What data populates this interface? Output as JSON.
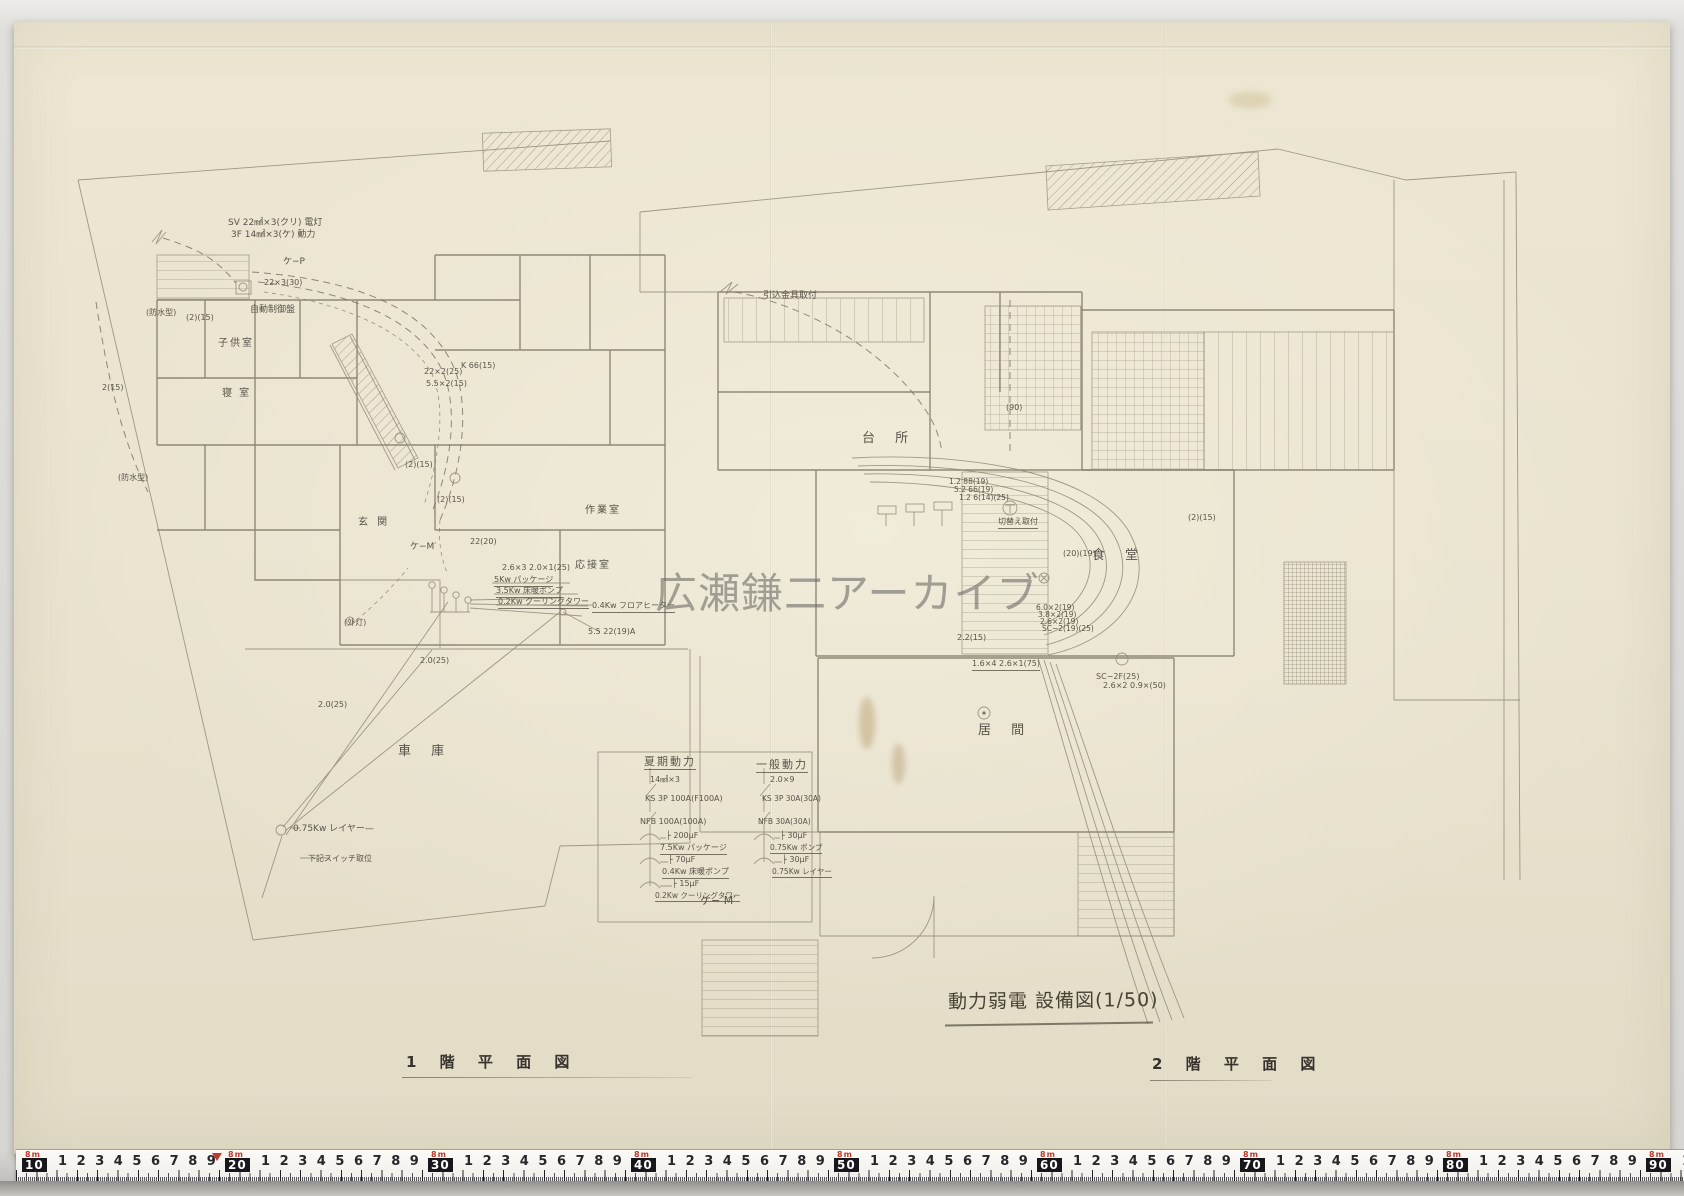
{
  "watermark": "広瀬鎌二アーカイブ",
  "sheet_title": "動力弱電 設備図(1/50)",
  "plan_titles": {
    "left": "1 階 平 面 図",
    "right": "2 階 平 面 図"
  },
  "labels": [
    {
      "t": "SV 22㎟×3(クリ) 電灯",
      "x": 228,
      "y": 219,
      "s": 9
    },
    {
      "t": "3F 14㎟×3(ケ) 動力",
      "x": 231,
      "y": 231,
      "s": 9
    },
    {
      "t": "ケ−P",
      "x": 283,
      "y": 258,
      "s": 9
    },
    {
      "t": "22×3(30)",
      "x": 264,
      "y": 279,
      "s": 8
    },
    {
      "t": "自動制御盤",
      "x": 250,
      "y": 306,
      "s": 9
    },
    {
      "t": "(防水型)",
      "x": 146,
      "y": 309,
      "s": 8
    },
    {
      "t": "(2)(15)",
      "x": 186,
      "y": 314,
      "s": 8
    },
    {
      "t": "2(15)",
      "x": 102,
      "y": 384,
      "s": 8
    },
    {
      "t": "(防水型)",
      "x": 118,
      "y": 474,
      "s": 8
    },
    {
      "t": "子供室",
      "x": 218,
      "y": 338,
      "s": 10,
      "ls": 2
    },
    {
      "t": "寝 室",
      "x": 222,
      "y": 388,
      "s": 10,
      "ls": 2
    },
    {
      "t": "玄 関",
      "x": 358,
      "y": 517,
      "s": 10,
      "ls": 3
    },
    {
      "t": "作業室",
      "x": 585,
      "y": 505,
      "s": 10,
      "ls": 2
    },
    {
      "t": "応接室",
      "x": 575,
      "y": 560,
      "s": 10,
      "ls": 2
    },
    {
      "t": "車 庫",
      "x": 398,
      "y": 745,
      "s": 13,
      "ls": 8
    },
    {
      "t": "22×2(25)",
      "x": 424,
      "y": 368,
      "s": 8
    },
    {
      "t": "K 66(15)",
      "x": 461,
      "y": 362,
      "s": 8
    },
    {
      "t": "5.5×2(15)",
      "x": 426,
      "y": 380,
      "s": 8
    },
    {
      "t": "(2)(15)",
      "x": 405,
      "y": 461,
      "s": 8
    },
    {
      "t": "(2)(15)",
      "x": 437,
      "y": 496,
      "s": 8
    },
    {
      "t": "22(20)",
      "x": 470,
      "y": 538,
      "s": 8
    },
    {
      "t": "ケ−M′",
      "x": 410,
      "y": 543,
      "s": 9
    },
    {
      "t": "2.6×3 2.0×1(25)",
      "x": 502,
      "y": 564,
      "s": 8
    },
    {
      "t": "5Kw パッケージ",
      "x": 494,
      "y": 576,
      "s": 8,
      "u": 1
    },
    {
      "t": "3.5Kw 床暖ポンプ",
      "x": 496,
      "y": 587,
      "s": 8,
      "u": 1
    },
    {
      "t": "0.2Kw クーリングタワー",
      "x": 498,
      "y": 598,
      "s": 8,
      "u": 1
    },
    {
      "t": "0.4Kw フロアヒーター",
      "x": 592,
      "y": 602,
      "s": 8,
      "u": 1
    },
    {
      "t": "5.5 22(19)A",
      "x": 588,
      "y": 628,
      "s": 8
    },
    {
      "t": "(外灯)",
      "x": 344,
      "y": 619,
      "s": 8
    },
    {
      "t": "2.0(25)",
      "x": 420,
      "y": 657,
      "s": 8
    },
    {
      "t": "2.0(25)",
      "x": 318,
      "y": 701,
      "s": 8
    },
    {
      "t": "0.75Kw レイヤー—",
      "x": 293,
      "y": 825,
      "s": 9
    },
    {
      "t": "下記スイッチ取位",
      "x": 308,
      "y": 855,
      "s": 8
    },
    {
      "t": "引込金具取付",
      "x": 763,
      "y": 292,
      "s": 9
    },
    {
      "t": "(90)",
      "x": 1006,
      "y": 404,
      "s": 8
    },
    {
      "t": "台 所",
      "x": 862,
      "y": 432,
      "s": 13,
      "ls": 8
    },
    {
      "t": "食 堂",
      "x": 1092,
      "y": 549,
      "s": 13,
      "ls": 8
    },
    {
      "t": "居 間",
      "x": 978,
      "y": 724,
      "s": 13,
      "ls": 8
    },
    {
      "t": "1.2 88(19)",
      "x": 949,
      "y": 478,
      "s": 7.5
    },
    {
      "t": "5.2 66(19)",
      "x": 954,
      "y": 486,
      "s": 7.5
    },
    {
      "t": "1.2 6(14)(25)",
      "x": 959,
      "y": 494,
      "s": 7.5
    },
    {
      "t": "切替え取付",
      "x": 998,
      "y": 518,
      "s": 8,
      "u": 1
    },
    {
      "t": "(20)(19)",
      "x": 1063,
      "y": 550,
      "s": 8
    },
    {
      "t": "(2)(15)",
      "x": 1188,
      "y": 514,
      "s": 8
    },
    {
      "t": "6.0×2(19)",
      "x": 1036,
      "y": 604,
      "s": 7.5
    },
    {
      "t": "3.8×2(19)",
      "x": 1038,
      "y": 611,
      "s": 7.5
    },
    {
      "t": "2.6×2(19)",
      "x": 1040,
      "y": 618,
      "s": 7.5
    },
    {
      "t": "SC−2(19)(25)",
      "x": 1042,
      "y": 625,
      "s": 7.5
    },
    {
      "t": "2.2(15)",
      "x": 957,
      "y": 634,
      "s": 8
    },
    {
      "t": "1.6×4 2.6×1(75)",
      "x": 972,
      "y": 660,
      "s": 8,
      "u": 1
    },
    {
      "t": "SC−2F(25)",
      "x": 1096,
      "y": 673,
      "s": 8
    },
    {
      "t": "2.6×2 0.9×(50)",
      "x": 1103,
      "y": 682,
      "s": 8
    },
    {
      "t": "夏期動力",
      "x": 644,
      "y": 756,
      "s": 11,
      "u": 1,
      "ls": 2
    },
    {
      "t": "一般動力",
      "x": 756,
      "y": 759,
      "s": 11,
      "u": 1,
      "ls": 2
    },
    {
      "t": "14㎟×3",
      "x": 650,
      "y": 776,
      "s": 8
    },
    {
      "t": "KS 3P 100A(F100A)",
      "x": 645,
      "y": 795,
      "s": 8
    },
    {
      "t": "NFB 100A(100A)",
      "x": 640,
      "y": 818,
      "s": 8
    },
    {
      "t": "├ 200μF",
      "x": 666,
      "y": 832,
      "s": 8
    },
    {
      "t": "7.5Kw パッケージ",
      "x": 660,
      "y": 844,
      "s": 8,
      "u": 1
    },
    {
      "t": "├ 70μF",
      "x": 668,
      "y": 856,
      "s": 8
    },
    {
      "t": "0.4Kw 床暖ポンプ",
      "x": 662,
      "y": 868,
      "s": 8,
      "u": 1
    },
    {
      "t": "├ 15μF",
      "x": 672,
      "y": 880,
      "s": 8
    },
    {
      "t": "0.2Kw クーリングタワー",
      "x": 655,
      "y": 892,
      "s": 7.5,
      "u": 1
    },
    {
      "t": "2.0×9",
      "x": 770,
      "y": 776,
      "s": 8
    },
    {
      "t": "KS 3P 30A(30A)",
      "x": 762,
      "y": 795,
      "s": 7.5
    },
    {
      "t": "NFB 30A(30A)",
      "x": 758,
      "y": 818,
      "s": 7.5
    },
    {
      "t": "├ 30μF",
      "x": 780,
      "y": 832,
      "s": 8
    },
    {
      "t": "0.75Kw ポンプ",
      "x": 770,
      "y": 844,
      "s": 7.5,
      "u": 1
    },
    {
      "t": "├ 30μF",
      "x": 782,
      "y": 856,
      "s": 8
    },
    {
      "t": "0.75Kw レイヤー",
      "x": 772,
      "y": 868,
      "s": 7.5,
      "u": 1
    },
    {
      "t": "ケ− M′",
      "x": 700,
      "y": 895,
      "s": 11
    }
  ],
  "ruler": {
    "meter_mark": "8m",
    "boxes": [
      "10",
      "20",
      "30",
      "40",
      "50",
      "60",
      "70",
      "80",
      "90"
    ],
    "digits": [
      "1",
      "2",
      "3",
      "4",
      "5",
      "6",
      "7",
      "8",
      "9"
    ]
  },
  "colors": {
    "paper": "#e8e2ce",
    "pencil": "#8f8a74",
    "ink": "#58544a",
    "ruler_red": "#c0392b"
  }
}
